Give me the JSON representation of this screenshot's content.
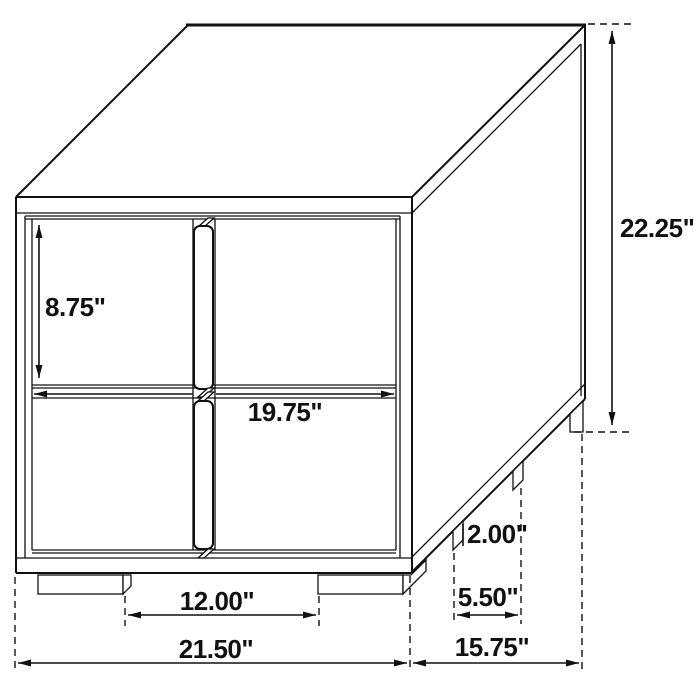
{
  "diagram": {
    "kind": "furniture-dimension-drawing",
    "dimensions": {
      "overall_height": "22.25\"",
      "drawer_height": "8.75\"",
      "drawer_width": "19.75\"",
      "foot_height": "2.00\"",
      "side_foot_spacing": "5.50\"",
      "front_foot_spacing": "12.00\"",
      "overall_width": "21.50\"",
      "overall_depth": "15.75\""
    },
    "colors": {
      "line": "#111111",
      "background": "#ffffff"
    }
  }
}
